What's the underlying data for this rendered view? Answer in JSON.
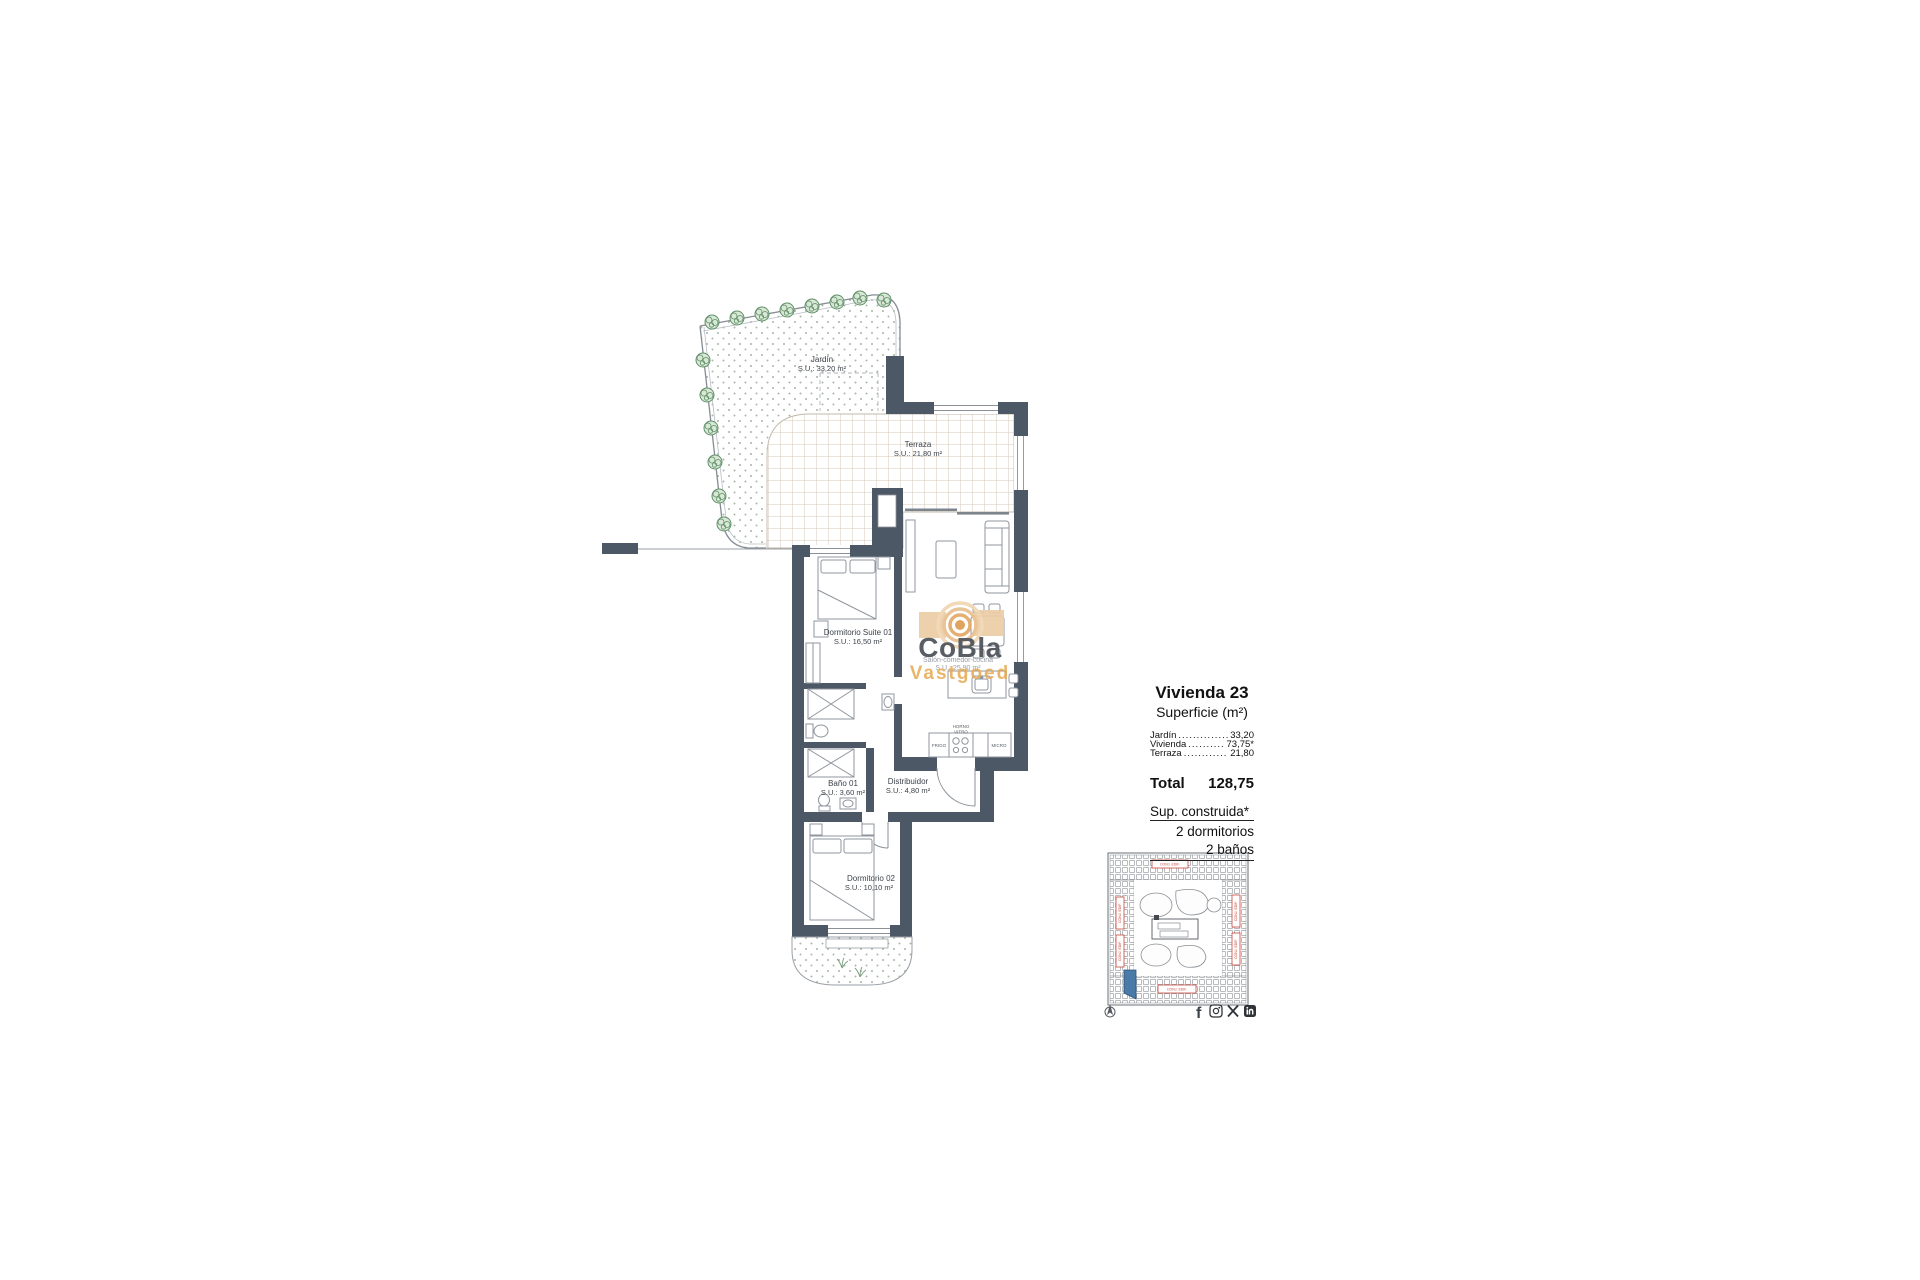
{
  "watermark": {
    "brand": "CoBla",
    "subbrand": "Vastgoed",
    "room": "Salón-comedor-cocina",
    "area": "S.U.: 25,90 m²"
  },
  "rooms": {
    "jardin": {
      "name": "Jardín",
      "area": "S.U.: 33,20 m²"
    },
    "terraza": {
      "name": "Terraza",
      "area": "S.U.: 21,80 m²"
    },
    "suite": {
      "name": "Dormitorio Suite 01",
      "area": "S.U.: 16,50 m²"
    },
    "bano1": {
      "name": "Baño 01",
      "area": "S.U.: 3,60 m²"
    },
    "distribuidor": {
      "name": "Distribuidor",
      "area": "S.U.: 4,80 m²"
    },
    "dorm2": {
      "name": "Dormitorio 02",
      "area": "S.U.: 10,10 m²"
    }
  },
  "kitchen": {
    "fridge": "FRIGO",
    "oven1": "HORNO",
    "oven2": "VITRO",
    "micro": "MICRO"
  },
  "info_panel": {
    "title": "Vivienda 23",
    "subtitle": "Superficie (m²)",
    "rows": [
      {
        "label": "Jardín",
        "dots": ".......................",
        "value": "33,20"
      },
      {
        "label": "Vivienda",
        "dots": ".......................",
        "value": "73,75*"
      },
      {
        "label": "Terraza",
        "dots": ".......................",
        "value": "21,80"
      }
    ],
    "total_label": "Total",
    "total_value": "128,75",
    "note": "Sup. construida*",
    "bedrooms": "2 dormitorios",
    "bathrooms": "2 baños"
  },
  "site_plan": {
    "labels": [
      "CONJ. EDIF.",
      "CONJ. EDIF.",
      "CONJ. EDIF.",
      "CONJ. EDIF.",
      "CONJ. EDIF.",
      "CONJ. EDIF."
    ]
  },
  "social": {
    "facebook_glyph": "f"
  },
  "colors": {
    "wall": "#4d5866",
    "brand_tan": "#e2a65c",
    "site_red": "#c9473a",
    "unit_blue": "#4a7aa8",
    "tree_green": "#5f8f68"
  }
}
